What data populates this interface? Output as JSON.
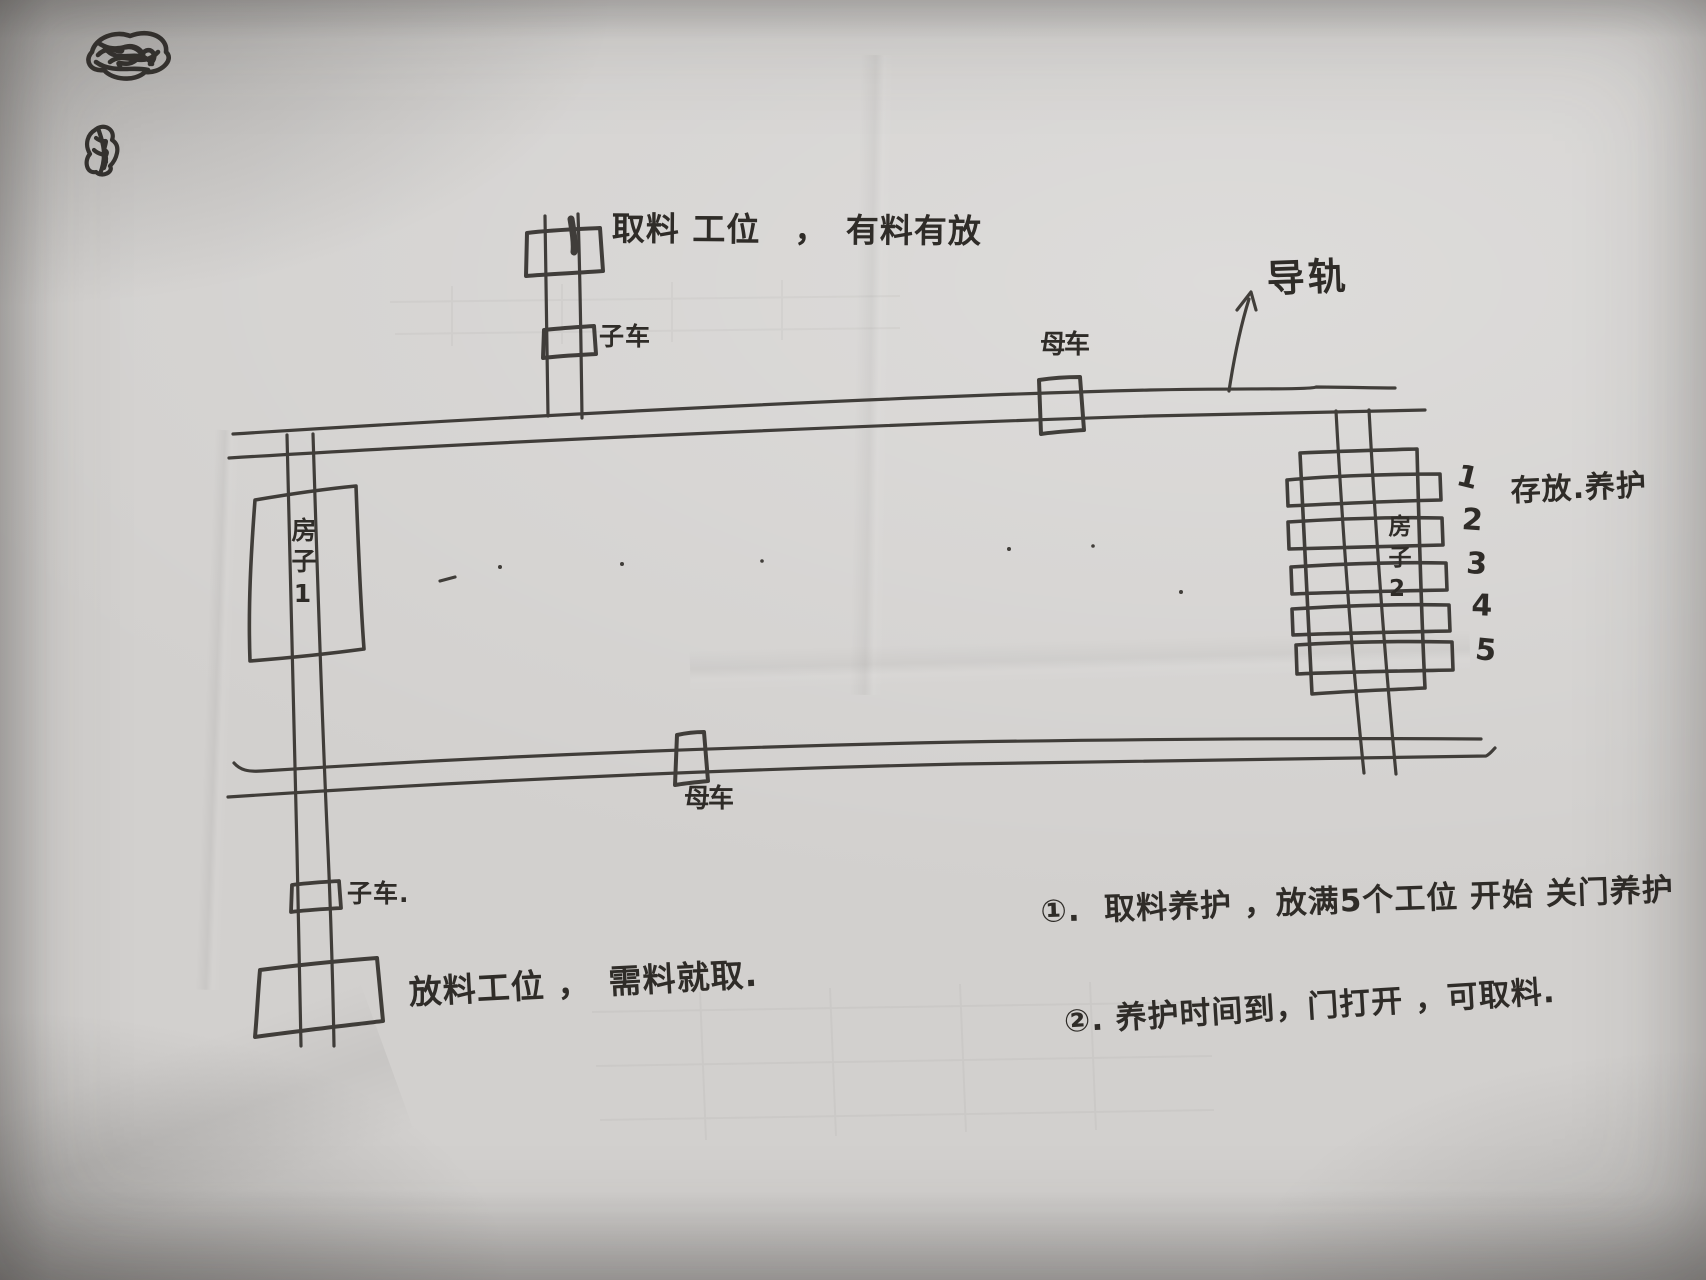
{
  "sketch": {
    "top_station": {
      "label": "取料 工位　，　有料有放",
      "cart_label": "子车"
    },
    "guide_rail": {
      "label": "导轨"
    },
    "carts": {
      "top_mother": "母车",
      "bottom_mother": "母车",
      "bottom_sub": "子车."
    },
    "house_left": {
      "label": "房子1"
    },
    "house_right": {
      "label": "房子2"
    },
    "storage_rack": {
      "label": "存放.养护",
      "slots": [
        "1",
        "2",
        "3",
        "4",
        "5"
      ]
    },
    "bottom_station": {
      "label": "放料工位 ，　需料就取."
    },
    "notes": [
      "①.  取料养护 ，放满5个工位 开始 关门养护",
      "②. 养护时间到，门打开 ，可取料."
    ]
  }
}
